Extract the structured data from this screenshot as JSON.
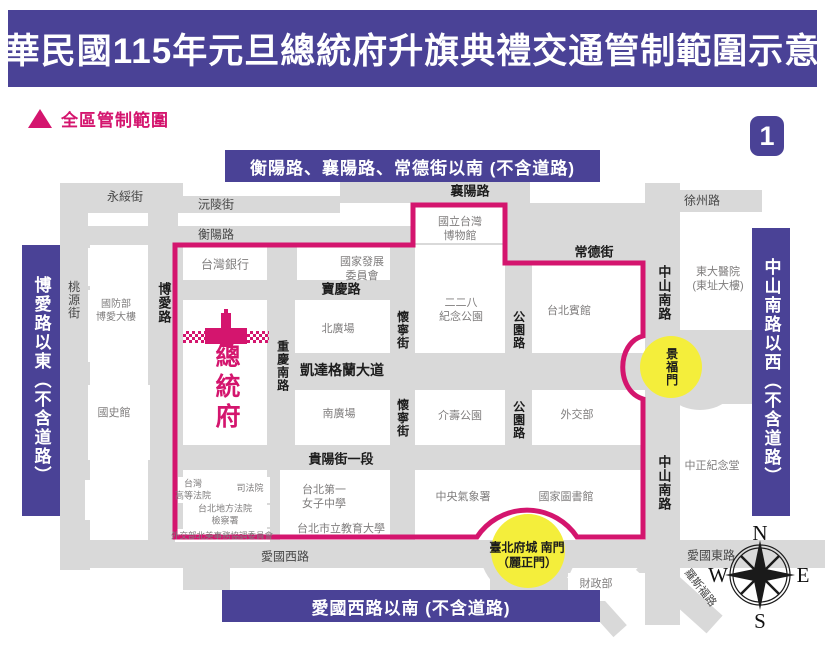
{
  "title": "中華民國115年元旦總統府升旗典禮交通管制範圍示意圖",
  "page_badge": "1",
  "legend": {
    "label": "全區管制範圍"
  },
  "banners": {
    "top": "衡陽路、襄陽路、常德街以南 (不含道路)",
    "left": "博愛路以東（不含道路）",
    "right": "中山南路以西（不含道路）",
    "bottom": "愛國西路以南 (不含道路)"
  },
  "compass": {
    "north": "N",
    "east": "E",
    "south": "S",
    "west": "W"
  },
  "colors": {
    "purple": "#4a4296",
    "pink": "#d4156e",
    "yellow": "#f4ee3b",
    "street_gray": "#d9d9d9"
  },
  "map": {
    "streets": [
      {
        "id": "west-column",
        "x": 60,
        "y": 183,
        "w": 30,
        "h": 387
      },
      {
        "id": "boai-road",
        "x": 148,
        "y": 183,
        "w": 35,
        "h": 385
      },
      {
        "id": "chongqing-s-road",
        "x": 267,
        "y": 226,
        "w": 30,
        "h": 320
      },
      {
        "id": "huaining-st",
        "x": 390,
        "y": 243,
        "w": 25,
        "h": 302
      },
      {
        "id": "gongyuan-road",
        "x": 505,
        "y": 203,
        "w": 27,
        "h": 342
      },
      {
        "id": "zhongshan-s-road",
        "x": 645,
        "y": 183,
        "w": 35,
        "h": 442
      },
      {
        "id": "yongsui-strip",
        "x": 60,
        "y": 183,
        "w": 115,
        "h": 30
      },
      {
        "id": "yuanling-strip",
        "x": 148,
        "y": 196,
        "w": 192,
        "h": 17
      },
      {
        "id": "hengyang-strip",
        "x": 60,
        "y": 226,
        "w": 470,
        "h": 19
      },
      {
        "id": "xiangyang-strip",
        "x": 340,
        "y": 180,
        "w": 190,
        "h": 23
      },
      {
        "id": "changde-junction",
        "x": 505,
        "y": 203,
        "w": 175,
        "h": 59
      },
      {
        "id": "xuzhou-strip",
        "x": 680,
        "y": 190,
        "w": 82,
        "h": 22
      },
      {
        "id": "baoqing-strip",
        "x": 175,
        "y": 280,
        "w": 240,
        "h": 20
      },
      {
        "id": "ketagalan-blvd",
        "x": 295,
        "y": 353,
        "w": 350,
        "h": 37
      },
      {
        "id": "guiyang-strip",
        "x": 175,
        "y": 445,
        "w": 470,
        "h": 25
      },
      {
        "id": "aiguo-w-strip",
        "x": 60,
        "y": 540,
        "w": 585,
        "h": 28
      },
      {
        "id": "aiguo-e-strip",
        "x": 645,
        "y": 540,
        "w": 180,
        "h": 28
      },
      {
        "id": "boai-stub",
        "x": 183,
        "y": 568,
        "w": 47,
        "h": 22
      },
      {
        "id": "jingfumen-plaza",
        "cx": 700,
        "cy": 365,
        "r": 45
      },
      {
        "id": "east-wedge",
        "x": 700,
        "y": 328,
        "w": 52,
        "h": 76
      },
      {
        "id": "southgate-plaza",
        "cx": 528,
        "cy": 550,
        "r": 48
      },
      {
        "id": "southgate-south-road",
        "x": 490,
        "y": 578,
        "w": 80,
        "h": 26
      },
      {
        "id": "roosevelt-road",
        "x": 652,
        "y": 552,
        "w": 95,
        "h": 24,
        "rot": 42
      },
      {
        "id": "ningbo-diagonal",
        "x": 588,
        "y": 582,
        "w": 58,
        "h": 18,
        "rot": 48
      }
    ],
    "blocks": [
      {
        "id": "blk-gap-1",
        "x": 178,
        "y": 213,
        "w": 122,
        "h": 13
      },
      {
        "id": "blk-gap-2",
        "x": 88,
        "y": 213,
        "w": 60,
        "h": 13
      },
      {
        "id": "blk-gap-3",
        "x": 88,
        "y": 248,
        "w": 60,
        "h": 38
      },
      {
        "id": "taiwan-bank",
        "x": 183,
        "y": 248,
        "w": 84,
        "h": 32
      },
      {
        "id": "presidential-block",
        "x": 183,
        "y": 300,
        "w": 84,
        "h": 145
      },
      {
        "id": "mnd-block",
        "x": 88,
        "y": 290,
        "w": 60,
        "h": 72
      },
      {
        "id": "academia-block",
        "x": 88,
        "y": 385,
        "w": 62,
        "h": 75
      },
      {
        "id": "blk-gap-4",
        "x": 85,
        "y": 480,
        "w": 55,
        "h": 40
      },
      {
        "id": "ndc-block",
        "x": 320,
        "y": 245,
        "w": 70,
        "h": 35
      },
      {
        "id": "museum-block",
        "x": 415,
        "y": 203,
        "w": 88,
        "h": 40
      },
      {
        "id": "peace-park-block",
        "x": 415,
        "y": 245,
        "w": 88,
        "h": 108
      },
      {
        "id": "north-plaza-block",
        "x": 295,
        "y": 300,
        "w": 95,
        "h": 53
      },
      {
        "id": "south-plaza-block",
        "x": 295,
        "y": 390,
        "w": 95,
        "h": 55
      },
      {
        "id": "jieshou-block",
        "x": 415,
        "y": 390,
        "w": 88,
        "h": 55
      },
      {
        "id": "guesthouse-block",
        "x": 532,
        "y": 262,
        "w": 113,
        "h": 91
      },
      {
        "id": "mofa-block",
        "x": 532,
        "y": 390,
        "w": 113,
        "h": 55
      },
      {
        "id": "hospital-block",
        "x": 680,
        "y": 212,
        "w": 82,
        "h": 118
      },
      {
        "id": "cks-block",
        "x": 680,
        "y": 430,
        "w": 75,
        "h": 110
      },
      {
        "id": "high-court-block",
        "x": 178,
        "y": 477,
        "w": 54,
        "h": 26
      },
      {
        "id": "judicial-block",
        "x": 234,
        "y": 477,
        "w": 36,
        "h": 26
      },
      {
        "id": "district-court-block",
        "x": 193,
        "y": 505,
        "w": 77,
        "h": 22
      },
      {
        "id": "aitc-block",
        "x": 175,
        "y": 529,
        "w": 95,
        "h": 13
      },
      {
        "id": "girls-school-block",
        "x": 280,
        "y": 470,
        "w": 110,
        "h": 70
      },
      {
        "id": "weather-block",
        "x": 415,
        "y": 470,
        "w": 117,
        "h": 70
      },
      {
        "id": "library-block",
        "x": 532,
        "y": 470,
        "w": 113,
        "h": 70
      },
      {
        "id": "finance-block",
        "x": 568,
        "y": 573,
        "w": 77,
        "h": 28
      }
    ],
    "labels": [
      {
        "id": "lbl-yongsui",
        "t": "永綏街",
        "x": 125,
        "y": 197,
        "o": "h",
        "b": 0,
        "s": 12,
        "k": "street"
      },
      {
        "id": "lbl-yuanling",
        "t": "沅陵街",
        "x": 216,
        "y": 205,
        "o": "h",
        "b": 0,
        "s": 12,
        "k": "street"
      },
      {
        "id": "lbl-hengyang",
        "t": "衡陽路",
        "x": 216,
        "y": 235,
        "o": "h",
        "b": 0,
        "s": 12,
        "k": "street"
      },
      {
        "id": "lbl-xiangyang",
        "t": "襄陽路",
        "x": 470,
        "y": 192,
        "o": "h",
        "b": 1,
        "s": 13,
        "k": "dark"
      },
      {
        "id": "lbl-changde",
        "t": "常德街",
        "x": 594,
        "y": 253,
        "o": "h",
        "b": 1,
        "s": 13,
        "k": "dark"
      },
      {
        "id": "lbl-xuzhou",
        "t": "徐州路",
        "x": 702,
        "y": 201,
        "o": "h",
        "b": 0,
        "s": 12,
        "k": "street"
      },
      {
        "id": "lbl-taoyuan",
        "t": "桃源街",
        "x": 73,
        "y": 300,
        "o": "v",
        "b": 0,
        "s": 12,
        "k": "street"
      },
      {
        "id": "lbl-boai",
        "t": "博愛路",
        "x": 163,
        "y": 303,
        "o": "v",
        "b": 1,
        "s": 13,
        "k": "dark"
      },
      {
        "id": "lbl-chongqing",
        "t": "重慶南路",
        "x": 282,
        "y": 366,
        "o": "v",
        "b": 1,
        "s": 12,
        "k": "dark"
      },
      {
        "id": "lbl-huaining-n",
        "t": "懷寧街",
        "x": 402,
        "y": 330,
        "o": "v",
        "b": 1,
        "s": 12,
        "k": "dark"
      },
      {
        "id": "lbl-huaining-s",
        "t": "懷寧街",
        "x": 402,
        "y": 418,
        "o": "v",
        "b": 1,
        "s": 12,
        "k": "dark"
      },
      {
        "id": "lbl-gongyuan-n",
        "t": "公園路",
        "x": 518,
        "y": 330,
        "o": "v",
        "b": 1,
        "s": 12,
        "k": "dark"
      },
      {
        "id": "lbl-gongyuan-s",
        "t": "公園路",
        "x": 518,
        "y": 420,
        "o": "v",
        "b": 1,
        "s": 12,
        "k": "dark"
      },
      {
        "id": "lbl-baoqing",
        "t": "寶慶路",
        "x": 341,
        "y": 290,
        "o": "h",
        "b": 1,
        "s": 13,
        "k": "dark"
      },
      {
        "id": "lbl-ketagalan",
        "t": "凱達格蘭大道",
        "x": 342,
        "y": 371,
        "o": "h",
        "b": 1,
        "s": 14,
        "k": "dark"
      },
      {
        "id": "lbl-guiyang",
        "t": "貴陽街一段",
        "x": 341,
        "y": 460,
        "o": "h",
        "b": 1,
        "s": 13,
        "k": "dark"
      },
      {
        "id": "lbl-aiguo-w",
        "t": "愛國西路",
        "x": 285,
        "y": 557,
        "o": "h",
        "b": 0,
        "s": 12,
        "k": "street"
      },
      {
        "id": "lbl-aiguo-e",
        "t": "愛國東路",
        "x": 711,
        "y": 556,
        "o": "h",
        "b": 0,
        "s": 12,
        "k": "street"
      },
      {
        "id": "lbl-zhongshan-n",
        "t": "中山南路",
        "x": 663,
        "y": 293,
        "o": "v",
        "b": 1,
        "s": 13,
        "k": "dark"
      },
      {
        "id": "lbl-zhongshan-s",
        "t": "中山南路",
        "x": 663,
        "y": 483,
        "o": "v",
        "b": 1,
        "s": 13,
        "k": "dark"
      },
      {
        "id": "lbl-roosevelt",
        "t": "羅斯福路",
        "x": 700,
        "y": 588,
        "o": "h",
        "b": 0,
        "s": 11,
        "k": "street",
        "rot": 52
      },
      {
        "id": "lbl-taiwan-bank",
        "t": "台灣銀行",
        "x": 225,
        "y": 265,
        "o": "h",
        "b": 0,
        "s": 12,
        "k": "bld"
      },
      {
        "id": "lbl-ndc",
        "t": "國家發展\n委員會",
        "x": 362,
        "y": 269,
        "o": "h",
        "b": 0,
        "s": 11,
        "k": "bld"
      },
      {
        "id": "lbl-museum",
        "t": "國立台灣\n博物館",
        "x": 460,
        "y": 229,
        "o": "h",
        "b": 0,
        "s": 11,
        "k": "bld"
      },
      {
        "id": "lbl-peace-park",
        "t": "二二八\n紀念公園",
        "x": 461,
        "y": 310,
        "o": "h",
        "b": 0,
        "s": 11,
        "k": "bld"
      },
      {
        "id": "lbl-guesthouse",
        "t": "台北賓館",
        "x": 569,
        "y": 311,
        "o": "h",
        "b": 0,
        "s": 11,
        "k": "bld"
      },
      {
        "id": "lbl-hospital",
        "t": "東大醫院\n(東址大樓)",
        "x": 718,
        "y": 279,
        "o": "h",
        "b": 0,
        "s": 11,
        "k": "bld"
      },
      {
        "id": "lbl-mnd",
        "t": "國防部\n博愛大樓",
        "x": 116,
        "y": 312,
        "o": "h",
        "b": 0,
        "s": 10,
        "k": "bld"
      },
      {
        "id": "lbl-north-plaza",
        "t": "北廣場",
        "x": 338,
        "y": 329,
        "o": "h",
        "b": 0,
        "s": 11,
        "k": "bld"
      },
      {
        "id": "lbl-south-plaza",
        "t": "南廣場",
        "x": 339,
        "y": 414,
        "o": "h",
        "b": 0,
        "s": 11,
        "k": "bld"
      },
      {
        "id": "lbl-jieshou",
        "t": "介壽公園",
        "x": 460,
        "y": 416,
        "o": "h",
        "b": 0,
        "s": 11,
        "k": "bld"
      },
      {
        "id": "lbl-mofa",
        "t": "外交部",
        "x": 577,
        "y": 415,
        "o": "h",
        "b": 0,
        "s": 11,
        "k": "bld"
      },
      {
        "id": "lbl-academia",
        "t": "國史館",
        "x": 114,
        "y": 413,
        "o": "h",
        "b": 0,
        "s": 11,
        "k": "bld"
      },
      {
        "id": "lbl-cks",
        "t": "中正紀念堂",
        "x": 712,
        "y": 466,
        "o": "h",
        "b": 0,
        "s": 11,
        "k": "bld"
      },
      {
        "id": "lbl-high-court",
        "t": "台灣\n高等法院",
        "x": 193,
        "y": 490,
        "o": "h",
        "b": 0,
        "s": 9,
        "k": "bld"
      },
      {
        "id": "lbl-judicial",
        "t": "司法院",
        "x": 250,
        "y": 489,
        "o": "h",
        "b": 0,
        "s": 9,
        "k": "bld"
      },
      {
        "id": "lbl-district-court",
        "t": "台北地方法院\n檢察署",
        "x": 225,
        "y": 515,
        "o": "h",
        "b": 0,
        "s": 9,
        "k": "bld"
      },
      {
        "id": "lbl-aitc",
        "t": "外交部北美事務協調委員會",
        "x": 222,
        "y": 536,
        "o": "h",
        "b": 0,
        "s": 8.5,
        "k": "bld"
      },
      {
        "id": "lbl-first-girls",
        "t": "台北第一\n女子中學",
        "x": 324,
        "y": 497,
        "o": "h",
        "b": 0,
        "s": 11,
        "k": "bld",
        "align": "left"
      },
      {
        "id": "lbl-uni-edu",
        "t": "台北市立教育大學",
        "x": 341,
        "y": 529,
        "o": "h",
        "b": 0,
        "s": 11,
        "k": "bld"
      },
      {
        "id": "lbl-weather",
        "t": "中央氣象署",
        "x": 463,
        "y": 497,
        "o": "h",
        "b": 0,
        "s": 11,
        "k": "bld"
      },
      {
        "id": "lbl-library",
        "t": "國家圖書館",
        "x": 566,
        "y": 497,
        "o": "h",
        "b": 0,
        "s": 11,
        "k": "bld"
      },
      {
        "id": "lbl-finance",
        "t": "財政部",
        "x": 596,
        "y": 584,
        "o": "h",
        "b": 0,
        "s": 11,
        "k": "bld"
      },
      {
        "id": "lbl-jingfumen",
        "t": "景福門",
        "x": 671,
        "y": 367,
        "o": "v",
        "b": 1,
        "s": 12,
        "k": "dark"
      },
      {
        "id": "lbl-south-gate",
        "t": "臺北府城 南門\n（麗正門）",
        "x": 527,
        "y": 556,
        "o": "h",
        "b": 1,
        "s": 12,
        "k": "dark"
      },
      {
        "id": "lbl-presidential-office",
        "t": "總統府",
        "x": 226,
        "y": 388,
        "o": "v",
        "b": 1,
        "s": 25,
        "k": "pink"
      }
    ],
    "landmarks": [
      {
        "id": "jingfumen-circle",
        "cx": 671,
        "cy": 367,
        "r": 31
      },
      {
        "id": "south-gate-circle",
        "cx": 528,
        "cy": 551,
        "r": 37
      }
    ]
  }
}
